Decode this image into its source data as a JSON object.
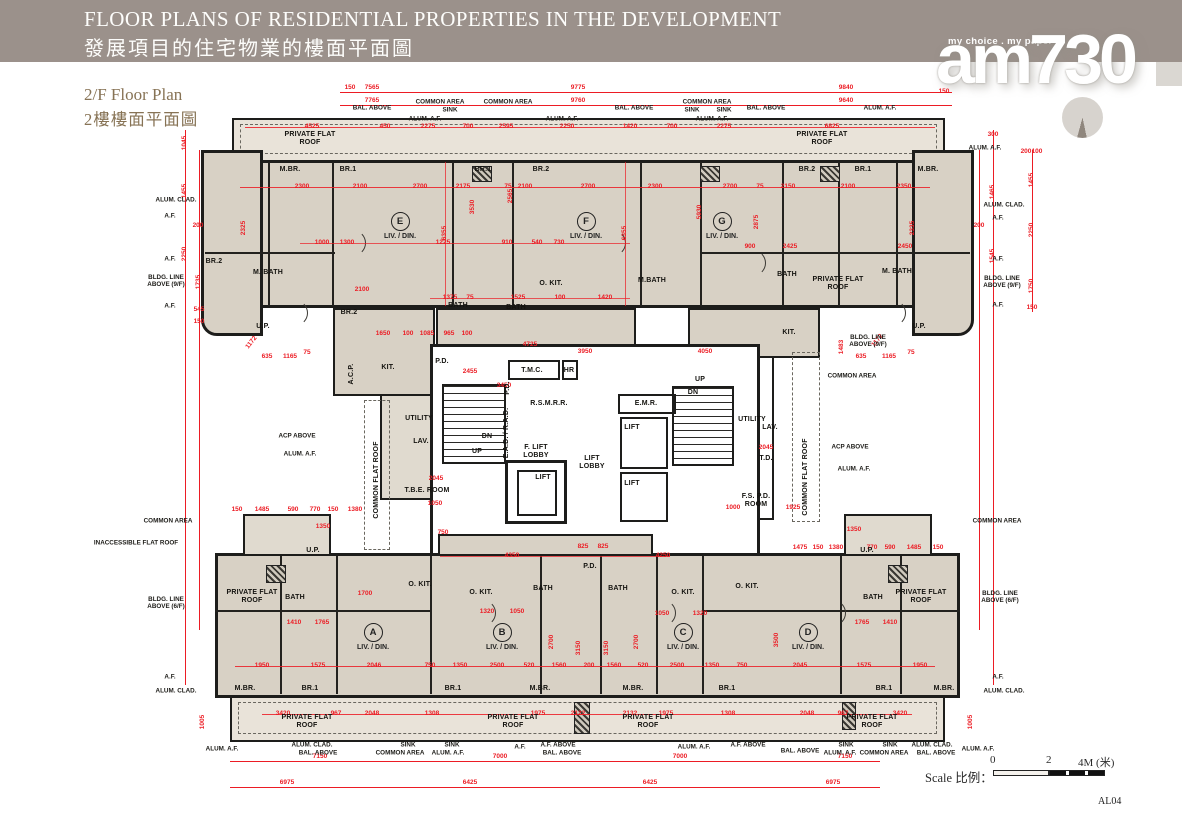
{
  "header": {
    "title_en": "FLOOR PLANS OF RESIDENTIAL PROPERTIES IN THE DEVELOPMENT",
    "title_zh": "發展項目的住宅物業的樓面平面圖"
  },
  "logo": {
    "tagline": "my choice . my paper",
    "name": "am730"
  },
  "plan_label": {
    "en": "2/F Floor Plan",
    "zh": "2樓樓面平面圖"
  },
  "scale_bar": {
    "label": "Scale 比例：",
    "tick0": "0",
    "tick2": "2",
    "tick4": "4M (米)"
  },
  "sheet_code": "AL04",
  "colors": {
    "dimension_red": "#ec1c24",
    "wall_black": "#1d1d1b",
    "unit_fill": "#d8d1c5",
    "roof_fill": "#e9e3d9",
    "header_bg": "#9b918b",
    "label_brown": "#877355"
  },
  "plan": {
    "liv_din": "LIV. / DIN.",
    "units": [
      [
        "E",
        400,
        226
      ],
      [
        "F",
        586,
        226
      ],
      [
        "G",
        722,
        226
      ],
      [
        "A",
        373,
        637
      ],
      [
        "B",
        502,
        637
      ],
      [
        "C",
        683,
        637
      ],
      [
        "D",
        808,
        637
      ]
    ],
    "rooms": [
      [
        "PRIVATE FLAT\nROOF",
        310,
        139
      ],
      [
        "PRIVATE FLAT\nROOF",
        822,
        139
      ],
      [
        "M.BR.",
        290,
        170
      ],
      [
        "BR.1",
        348,
        170
      ],
      [
        "BR.1",
        483,
        170
      ],
      [
        "BR.2",
        541,
        170
      ],
      [
        "BR.2",
        807,
        170
      ],
      [
        "BR.1",
        863,
        170
      ],
      [
        "M.BR.",
        928,
        170
      ],
      [
        "BR.2",
        214,
        262
      ],
      [
        "M. BATH",
        268,
        273
      ],
      [
        "BR.2",
        349,
        313
      ],
      [
        "KIT.",
        388,
        368
      ],
      [
        "BATH",
        458,
        306
      ],
      [
        "BATH",
        516,
        308
      ],
      [
        "O. KIT.",
        551,
        284
      ],
      [
        "M.BATH",
        652,
        281
      ],
      [
        "BATH",
        787,
        275
      ],
      [
        "M. BATH",
        897,
        272
      ],
      [
        "PRIVATE FLAT\nROOF",
        838,
        284
      ],
      [
        "KIT.",
        789,
        333
      ],
      [
        "U.P.",
        263,
        327
      ],
      [
        "U.P.",
        919,
        327
      ],
      [
        "UTILITY",
        419,
        419
      ],
      [
        "LAV.",
        421,
        442
      ],
      [
        "T.M.C.",
        532,
        371
      ],
      [
        "HR",
        569,
        371
      ],
      [
        "P.D.",
        442,
        362
      ],
      [
        "P.D.",
        508,
        388,
        "v"
      ],
      [
        "R.S.M.R.R.",
        549,
        404
      ],
      [
        "E.A.D. / R.A.D.",
        507,
        433,
        "v"
      ],
      [
        "DN",
        487,
        437
      ],
      [
        "UP",
        477,
        452
      ],
      [
        "F. LIFT\nLOBBY",
        536,
        452
      ],
      [
        "LIFT\nLOBBY",
        592,
        463
      ],
      [
        "LIFT",
        543,
        478
      ],
      [
        "E.M.R.",
        646,
        404
      ],
      [
        "LIFT",
        632,
        428
      ],
      [
        "LIFT",
        632,
        484
      ],
      [
        "UP",
        700,
        380
      ],
      [
        "DN",
        693,
        393
      ],
      [
        "T.B.E. ROOM",
        427,
        491
      ],
      [
        "UTILITY",
        752,
        420
      ],
      [
        "LAV.",
        770,
        428
      ],
      [
        "T.D.",
        766,
        459
      ],
      [
        "F.S. P.D.\nROOM",
        756,
        501
      ],
      [
        "COMMON FLAT ROOF",
        377,
        480,
        "v"
      ],
      [
        "COMMON FLAT ROOF",
        806,
        477,
        "v"
      ],
      [
        "A.C.P.",
        352,
        374,
        "v"
      ],
      [
        "O. KIT.",
        420,
        585
      ],
      [
        "O. KIT.",
        481,
        593
      ],
      [
        "O. KIT.",
        683,
        593
      ],
      [
        "O. KIT.",
        747,
        587
      ],
      [
        "BATH",
        295,
        598
      ],
      [
        "BATH",
        543,
        589
      ],
      [
        "BATH",
        618,
        589
      ],
      [
        "BATH",
        873,
        598
      ],
      [
        "P.D.",
        590,
        567
      ],
      [
        "M.BR.",
        245,
        689
      ],
      [
        "BR.1",
        310,
        689
      ],
      [
        "BR.1",
        453,
        689
      ],
      [
        "M.BR.",
        540,
        689
      ],
      [
        "M.BR.",
        633,
        689
      ],
      [
        "BR.1",
        727,
        689
      ],
      [
        "BR.1",
        884,
        689
      ],
      [
        "M.BR.",
        944,
        689
      ],
      [
        "U.P.",
        313,
        551
      ],
      [
        "U.P.",
        867,
        551
      ],
      [
        "PRIVATE FLAT\nROOF",
        252,
        597
      ],
      [
        "PRIVATE FLAT\nROOF",
        921,
        597
      ],
      [
        "PRIVATE FLAT\nROOF",
        307,
        722
      ],
      [
        "PRIVATE FLAT\nROOF",
        513,
        722
      ],
      [
        "PRIVATE FLAT\nROOF",
        648,
        722
      ],
      [
        "PRIVATE FLAT\nROOF",
        872,
        722
      ]
    ],
    "callouts": [
      [
        "BAL. ABOVE",
        372,
        108
      ],
      [
        "COMMON AREA",
        440,
        102
      ],
      [
        "SINK",
        450,
        110
      ],
      [
        "ALUM. A.F.",
        425,
        119
      ],
      [
        "COMMON AREA",
        508,
        102
      ],
      [
        "ALUM. A.F.",
        562,
        119
      ],
      [
        "BAL. ABOVE",
        634,
        108
      ],
      [
        "COMMON AREA",
        707,
        102
      ],
      [
        "SINK",
        692,
        110
      ],
      [
        "SINK",
        724,
        110
      ],
      [
        "ALUM. A.F.",
        712,
        119
      ],
      [
        "BAL. ABOVE",
        766,
        108
      ],
      [
        "ALUM. A.F.",
        880,
        108
      ],
      [
        "ALUM. A.F.",
        985,
        148
      ],
      [
        "ALUM. CLAD.",
        176,
        200
      ],
      [
        "A.F.",
        170,
        216
      ],
      [
        "ALUM. CLAD.",
        1004,
        205
      ],
      [
        "A.F.",
        998,
        218
      ],
      [
        "A.F.",
        170,
        259
      ],
      [
        "BLDG. LINE\nABOVE (9/F)",
        166,
        281
      ],
      [
        "A.F.",
        170,
        306
      ],
      [
        "A.F.",
        998,
        259
      ],
      [
        "BLDG. LINE\nABOVE (9/F)",
        1002,
        282
      ],
      [
        "A.F.",
        998,
        305
      ],
      [
        "BLDG. LINE\nABOVE (9/F)",
        868,
        341
      ],
      [
        "COMMON AREA",
        852,
        376
      ],
      [
        "ACP ABOVE",
        850,
        447
      ],
      [
        "ALUM. A.F.",
        854,
        469
      ],
      [
        "ACP ABOVE",
        297,
        436
      ],
      [
        "ALUM. A.F.",
        300,
        454
      ],
      [
        "COMMON AREA",
        168,
        521
      ],
      [
        "INACCESSIBLE FLAT ROOF",
        136,
        543
      ],
      [
        "COMMON AREA",
        997,
        521
      ],
      [
        "BLDG. LINE\nABOVE (6/F)",
        166,
        603
      ],
      [
        "BLDG. LINE\nABOVE (6/F)",
        1000,
        597
      ],
      [
        "A.F.",
        170,
        677
      ],
      [
        "ALUM. CLAD.",
        176,
        691
      ],
      [
        "A.F.",
        998,
        677
      ],
      [
        "ALUM. CLAD.",
        1004,
        691
      ],
      [
        "ALUM. A.F.",
        222,
        749
      ],
      [
        "ALUM. CLAD.",
        312,
        745
      ],
      [
        "BAL. ABOVE",
        318,
        753
      ],
      [
        "SINK",
        408,
        745
      ],
      [
        "COMMON AREA",
        400,
        753
      ],
      [
        "SINK",
        452,
        745
      ],
      [
        "ALUM. A.F.",
        448,
        753
      ],
      [
        "A.F.",
        520,
        747
      ],
      [
        "A.F. ABOVE",
        558,
        745
      ],
      [
        "BAL. ABOVE",
        562,
        753
      ],
      [
        "ALUM. A.F.",
        694,
        747
      ],
      [
        "A.F. ABOVE",
        748,
        745
      ],
      [
        "BAL. ABOVE",
        800,
        751
      ],
      [
        "SINK",
        846,
        745
      ],
      [
        "ALUM. A.F.",
        840,
        753
      ],
      [
        "SINK",
        890,
        745
      ],
      [
        "COMMON AREA",
        884,
        753
      ],
      [
        "ALUM. CLAD.",
        932,
        745
      ],
      [
        "BAL. ABOVE",
        936,
        753
      ],
      [
        "ALUM. A.F.",
        978,
        749
      ]
    ],
    "dims": [
      [
        "150",
        350,
        88
      ],
      [
        "7565",
        372,
        88
      ],
      [
        "9775",
        578,
        88
      ],
      [
        "9840",
        846,
        88
      ],
      [
        "150",
        944,
        92
      ],
      [
        "7765",
        372,
        101
      ],
      [
        "9760",
        578,
        101
      ],
      [
        "9640",
        846,
        101
      ],
      [
        "4525",
        312,
        127
      ],
      [
        "450",
        385,
        127
      ],
      [
        "2275",
        428,
        127
      ],
      [
        "700",
        468,
        127
      ],
      [
        "2595",
        506,
        127
      ],
      [
        "2250",
        567,
        127
      ],
      [
        "1420",
        630,
        127
      ],
      [
        "700",
        672,
        127
      ],
      [
        "2275",
        724,
        127
      ],
      [
        "6825",
        832,
        127
      ],
      [
        "1045",
        185,
        143,
        "v"
      ],
      [
        "1455",
        185,
        191,
        "v"
      ],
      [
        "2250",
        185,
        254,
        "v"
      ],
      [
        "200",
        198,
        226
      ],
      [
        "1735",
        199,
        282,
        "v"
      ],
      [
        "545",
        199,
        310
      ],
      [
        "150",
        199,
        322
      ],
      [
        "300",
        993,
        135
      ],
      [
        "1465",
        993,
        192,
        "v"
      ],
      [
        "1545",
        993,
        256,
        "v"
      ],
      [
        "200",
        979,
        226
      ],
      [
        "200",
        1026,
        152
      ],
      [
        "100",
        1037,
        152
      ],
      [
        "1455",
        1032,
        180,
        "v"
      ],
      [
        "2250",
        1032,
        230,
        "v"
      ],
      [
        "1750",
        1032,
        286,
        "v"
      ],
      [
        "150",
        1032,
        308
      ],
      [
        "2300",
        302,
        187
      ],
      [
        "2100",
        360,
        187
      ],
      [
        "2700",
        420,
        187
      ],
      [
        "2175",
        463,
        187
      ],
      [
        "2100",
        525,
        187
      ],
      [
        "2700",
        588,
        187
      ],
      [
        "2300",
        655,
        187
      ],
      [
        "2700",
        730,
        187
      ],
      [
        "2150",
        788,
        187
      ],
      [
        "2100",
        848,
        187
      ],
      [
        "2350",
        904,
        187
      ],
      [
        "75",
        508,
        187
      ],
      [
        "75",
        760,
        187
      ],
      [
        "6355",
        445,
        233,
        "v"
      ],
      [
        "6355",
        625,
        233,
        "v"
      ],
      [
        "3530",
        473,
        207,
        "v"
      ],
      [
        "2565",
        511,
        196,
        "v"
      ],
      [
        "5930",
        700,
        212,
        "v"
      ],
      [
        "2325",
        244,
        228,
        "v"
      ],
      [
        "2335",
        913,
        228,
        "v"
      ],
      [
        "2875",
        757,
        222,
        "v"
      ],
      [
        "1000",
        322,
        243
      ],
      [
        "1300",
        347,
        243
      ],
      [
        "1225",
        443,
        243
      ],
      [
        "910",
        507,
        243
      ],
      [
        "540",
        537,
        243
      ],
      [
        "730",
        559,
        243
      ],
      [
        "2425",
        790,
        247
      ],
      [
        "900",
        750,
        247
      ],
      [
        "2450",
        905,
        247
      ],
      [
        "2100",
        362,
        290
      ],
      [
        "1375",
        450,
        298
      ],
      [
        "75",
        470,
        298
      ],
      [
        "1525",
        518,
        298
      ],
      [
        "100",
        560,
        298
      ],
      [
        "1420",
        605,
        298
      ],
      [
        "1650",
        383,
        334
      ],
      [
        "100",
        408,
        334
      ],
      [
        "1085",
        427,
        334
      ],
      [
        "965",
        449,
        334
      ],
      [
        "100",
        467,
        334
      ],
      [
        "4725",
        530,
        345
      ],
      [
        "3950",
        585,
        352
      ],
      [
        "4050",
        705,
        352
      ],
      [
        "1172",
        252,
        343,
        "r"
      ],
      [
        "635",
        267,
        357
      ],
      [
        "1165",
        290,
        357
      ],
      [
        "75",
        307,
        353
      ],
      [
        "1172",
        878,
        341,
        "r"
      ],
      [
        "635",
        861,
        357
      ],
      [
        "1165",
        889,
        357
      ],
      [
        "75",
        911,
        353
      ],
      [
        "2455",
        470,
        372
      ],
      [
        "3450",
        504,
        386
      ],
      [
        "2045",
        436,
        479
      ],
      [
        "1050",
        435,
        504
      ],
      [
        "750",
        443,
        533
      ],
      [
        "2045",
        766,
        448
      ],
      [
        "1000",
        733,
        508
      ],
      [
        "1925",
        793,
        508
      ],
      [
        "1483",
        842,
        347,
        "v"
      ],
      [
        "150",
        237,
        510
      ],
      [
        "1485",
        262,
        510
      ],
      [
        "590",
        293,
        510
      ],
      [
        "770",
        315,
        510
      ],
      [
        "150",
        333,
        510
      ],
      [
        "1380",
        355,
        510
      ],
      [
        "1350",
        323,
        527
      ],
      [
        "1475",
        800,
        548
      ],
      [
        "150",
        818,
        548
      ],
      [
        "1380",
        836,
        548
      ],
      [
        "770",
        872,
        548
      ],
      [
        "590",
        890,
        548
      ],
      [
        "1485",
        914,
        548
      ],
      [
        "150",
        938,
        548
      ],
      [
        "1350",
        854,
        530
      ],
      [
        "825",
        583,
        547
      ],
      [
        "825",
        603,
        547
      ],
      [
        "4350",
        512,
        556
      ],
      [
        "4250",
        663,
        556
      ],
      [
        "1700",
        365,
        594
      ],
      [
        "1320",
        487,
        612
      ],
      [
        "1050",
        517,
        612
      ],
      [
        "1050",
        662,
        614
      ],
      [
        "1320",
        700,
        614
      ],
      [
        "1410",
        294,
        623
      ],
      [
        "1765",
        322,
        623
      ],
      [
        "1765",
        862,
        623
      ],
      [
        "1410",
        890,
        623
      ],
      [
        "3150",
        579,
        648,
        "v"
      ],
      [
        "3150",
        607,
        648,
        "v"
      ],
      [
        "2700",
        552,
        642,
        "v"
      ],
      [
        "2700",
        637,
        642,
        "v"
      ],
      [
        "3500",
        777,
        640,
        "v"
      ],
      [
        "1950",
        262,
        666
      ],
      [
        "1575",
        318,
        666
      ],
      [
        "2046",
        374,
        666
      ],
      [
        "750",
        430,
        666
      ],
      [
        "1350",
        460,
        666
      ],
      [
        "2500",
        497,
        666
      ],
      [
        "520",
        529,
        666
      ],
      [
        "1560",
        559,
        666
      ],
      [
        "200",
        589,
        666
      ],
      [
        "1560",
        614,
        666
      ],
      [
        "520",
        643,
        666
      ],
      [
        "2500",
        677,
        666
      ],
      [
        "1350",
        712,
        666
      ],
      [
        "750",
        742,
        666
      ],
      [
        "2045",
        800,
        666
      ],
      [
        "1575",
        864,
        666
      ],
      [
        "1950",
        920,
        666
      ],
      [
        "3420",
        283,
        714
      ],
      [
        "967",
        336,
        714
      ],
      [
        "2048",
        372,
        714
      ],
      [
        "1308",
        432,
        714
      ],
      [
        "1975",
        538,
        714
      ],
      [
        "2122",
        578,
        714
      ],
      [
        "2132",
        630,
        714
      ],
      [
        "1975",
        666,
        714
      ],
      [
        "1308",
        728,
        714
      ],
      [
        "2048",
        807,
        714
      ],
      [
        "967",
        843,
        714
      ],
      [
        "3420",
        900,
        714
      ],
      [
        "7150",
        320,
        757
      ],
      [
        "7000",
        500,
        757
      ],
      [
        "7000",
        680,
        757
      ],
      [
        "7150",
        845,
        757
      ],
      [
        "6975",
        287,
        783
      ],
      [
        "6425",
        470,
        783
      ],
      [
        "6425",
        650,
        783
      ],
      [
        "6975",
        833,
        783
      ],
      [
        "1005",
        203,
        722,
        "v"
      ],
      [
        "1005",
        971,
        722,
        "v"
      ]
    ]
  }
}
